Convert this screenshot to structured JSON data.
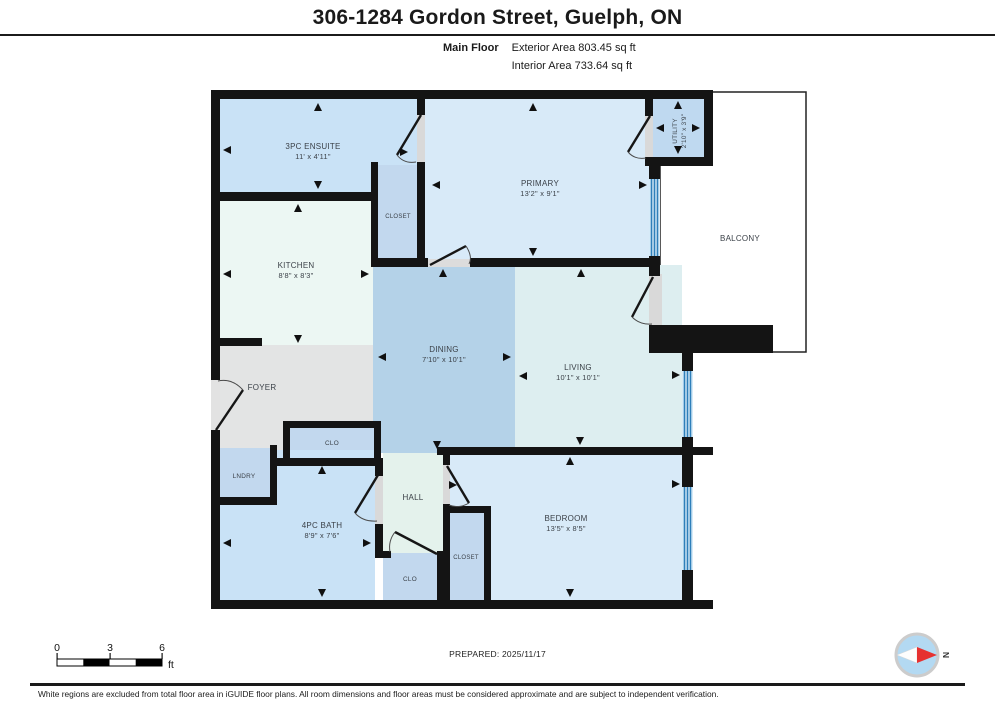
{
  "header": {
    "title": "306-1284 Gordon Street, Guelph, ON",
    "floor_label": "Main Floor",
    "exterior_area": "Exterior Area 803.45 sq ft",
    "interior_area": "Interior Area 733.64 sq ft"
  },
  "rooms": {
    "ensuite": {
      "name": "3PC ENSUITE",
      "dims": "11' x 4'11\""
    },
    "closet_ensuite": {
      "name": "CLOSET"
    },
    "primary": {
      "name": "PRIMARY",
      "dims": "13'2\" x 9'1\""
    },
    "utility": {
      "name": "UTILITY",
      "dims": "2'10\" x 3'9\""
    },
    "balcony": {
      "name": "BALCONY"
    },
    "kitchen": {
      "name": "KITCHEN",
      "dims": "8'8\" x 8'3\""
    },
    "foyer": {
      "name": "FOYER"
    },
    "dining": {
      "name": "DINING",
      "dims": "7'10\" x 10'1\""
    },
    "living": {
      "name": "LIVING",
      "dims": "10'1\" x 10'1\""
    },
    "clo_foyer": {
      "name": "CLO"
    },
    "lndry": {
      "name": "LNDRY"
    },
    "bath": {
      "name": "4PC BATH",
      "dims": "8'9\" x 7'6\""
    },
    "hall": {
      "name": "HALL"
    },
    "clo_hall": {
      "name": "CLO"
    },
    "closet_bedroom": {
      "name": "CLOSET"
    },
    "bedroom": {
      "name": "BEDROOM",
      "dims": "13'5\" x 8'5\""
    }
  },
  "footer": {
    "prepared": "PREPARED: 2025/11/17",
    "disclaimer": "White regions are excluded from total floor area in iGUIDE floor plans. All room dimensions and floor areas must be considered approximate and are subject to independent verification.",
    "scale": {
      "start": "0",
      "mid": "3",
      "end": "6",
      "unit": "ft"
    },
    "compass_label": "N"
  },
  "colors": {
    "wall": "#141414",
    "window_blue": "#2e7fba",
    "dining_fill": "#b4d2e8",
    "compass_red": "#e63130"
  }
}
